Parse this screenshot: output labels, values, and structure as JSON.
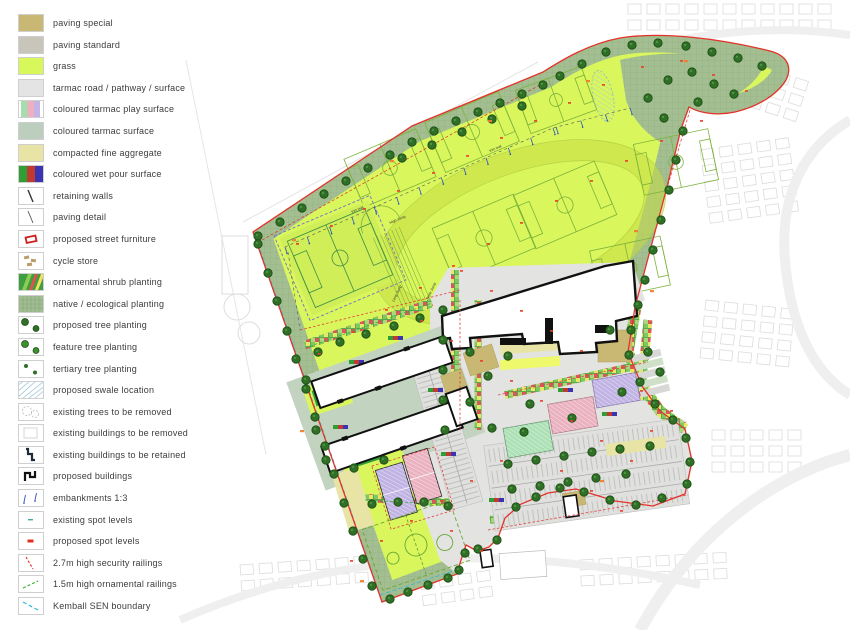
{
  "legend": {
    "items": [
      {
        "key": "paving_special",
        "label": "paving special"
      },
      {
        "key": "paving_standard",
        "label": "paving standard"
      },
      {
        "key": "grass",
        "label": "grass"
      },
      {
        "key": "tarmac",
        "label": "tarmac road / pathway / surface"
      },
      {
        "key": "play_surface",
        "label": "coloured tarmac play surface"
      },
      {
        "key": "coloured_tarmac",
        "label": "coloured tarmac surface"
      },
      {
        "key": "aggregate",
        "label": "compacted fine aggregate"
      },
      {
        "key": "wet_pour",
        "label": "coloured wet pour surface"
      },
      {
        "key": "retaining",
        "label": "retaining walls"
      },
      {
        "key": "paving_detail",
        "label": "paving detail"
      },
      {
        "key": "street_furniture",
        "label": "proposed street furniture"
      },
      {
        "key": "cycle_store",
        "label": "cycle store"
      },
      {
        "key": "ornamental_shrub",
        "label": "ornamental shrub planting"
      },
      {
        "key": "native_planting",
        "label": "native / ecological planting"
      },
      {
        "key": "tree_proposed",
        "label": "proposed tree planting"
      },
      {
        "key": "tree_feature",
        "label": "feature tree planting"
      },
      {
        "key": "tree_tertiary",
        "label": "tertiary tree planting"
      },
      {
        "key": "swale",
        "label": "proposed swale location"
      },
      {
        "key": "trees_removed",
        "label": "existing trees to be removed"
      },
      {
        "key": "bldg_removed",
        "label": "existing buildings to be removed"
      },
      {
        "key": "bldg_retained",
        "label": "existing buildings to be retained"
      },
      {
        "key": "bldg_proposed",
        "label": "proposed buildings"
      },
      {
        "key": "embankments",
        "label": "embankments 1:3"
      },
      {
        "key": "spot_existing",
        "label": "existing spot levels"
      },
      {
        "key": "spot_proposed",
        "label": "proposed spot levels"
      },
      {
        "key": "railing_security",
        "label": "2.7m high security railings"
      },
      {
        "key": "railing_ornamental",
        "label": "1.5m high ornamental railings"
      },
      {
        "key": "sen_boundary",
        "label": "Kemball SEN boundary"
      }
    ]
  },
  "map": {
    "labels": {
      "high_jump": "High Jump",
      "long_jump": "Long Jump",
      "triple_jump": "Triple Jump",
      "trim_trail": "trim trail"
    }
  },
  "colors": {
    "boundary_red": "#e2332a",
    "grass": "#d9f65c",
    "native_planting": "#a3bf92",
    "tarmac": "#e3e3e1",
    "coloured_tarmac": "#c2d3c0",
    "aggregate": "#e8e4a6",
    "paving_special": "#c9b873",
    "court_green": "#ace0b5",
    "court_pink": "#eab2c0",
    "court_purple": "#c1b4e4",
    "wetpour_green": "#2e9e35",
    "wetpour_red": "#c03a31",
    "wetpour_blue": "#3a34b2",
    "tree": "#2f7026",
    "sen_boundary_cyan": "#35b8d8",
    "ornamental_railing_green": "#35b035"
  }
}
